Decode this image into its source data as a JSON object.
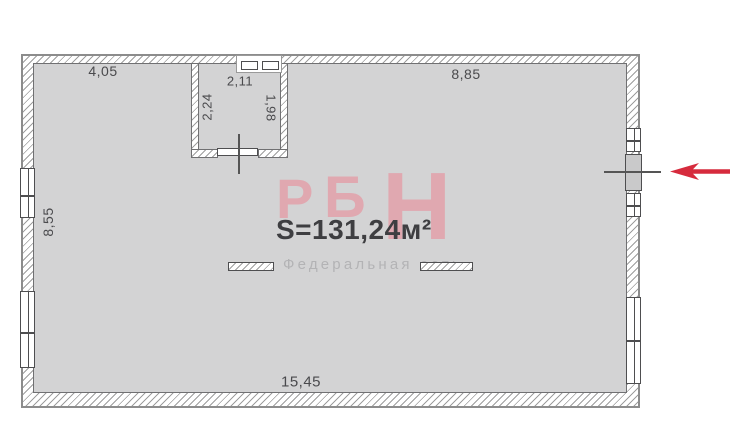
{
  "plan": {
    "area_label": "S=131,24м²",
    "brand": {
      "letters": [
        "Р",
        "Б",
        "Н"
      ],
      "tagline": "Федеральная сеть"
    },
    "dimensions": {
      "top_left_width": "4,05",
      "top_right_width": "8,85",
      "wc_width": "2,11",
      "wc_height_left": "2,24",
      "wc_height_right": "1,98",
      "left_height": "8,55",
      "bottom_width": "15,45"
    },
    "entrance": {
      "arrow_direction": "left"
    },
    "colors": {
      "brand_pink": "#e0a8b0",
      "area_text": "#3e3e41",
      "dimension_text": "#4a4a4d",
      "tagline_text": "#b3b3b5",
      "arrow_red": "#d62b3d",
      "interior_gray": "#d3d3d4"
    }
  }
}
